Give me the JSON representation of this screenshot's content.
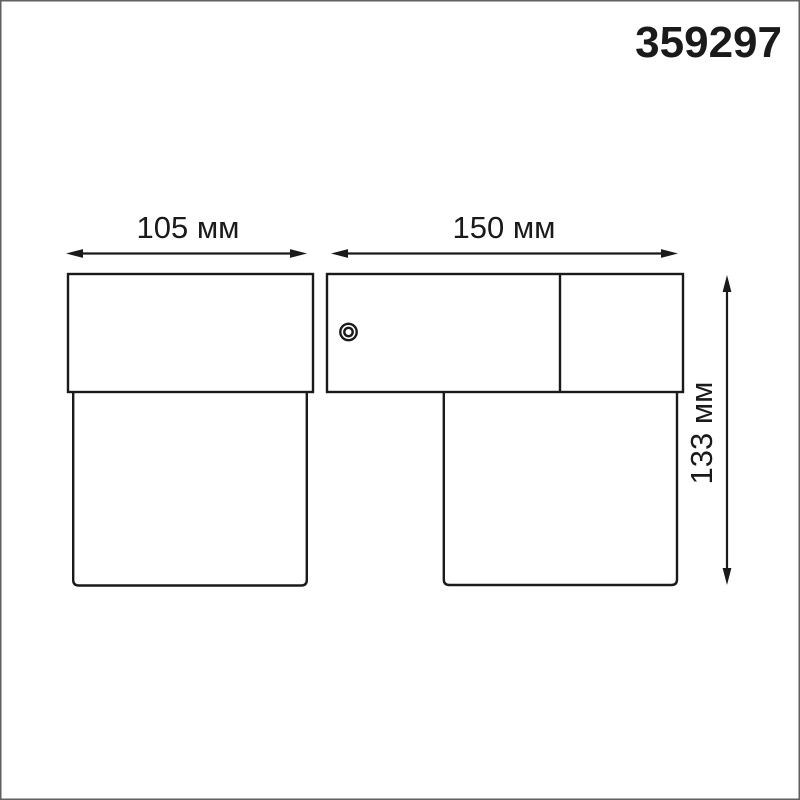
{
  "header": {
    "article_number": "359297"
  },
  "dimensions": {
    "width_left": {
      "label": "105 мм",
      "value_mm": 105
    },
    "width_right": {
      "label": "150 мм",
      "value_mm": 150
    },
    "height": {
      "label": "133 мм",
      "value_mm": 133
    }
  },
  "colors": {
    "background": "#ffffff",
    "line": "#1a1a1a",
    "frame_border": "#606060"
  }
}
